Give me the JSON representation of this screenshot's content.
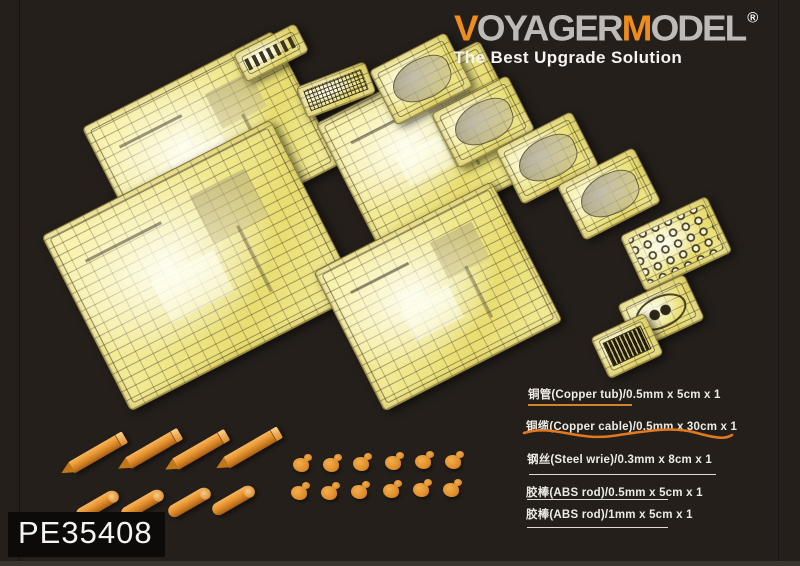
{
  "brand": {
    "wordmark": {
      "v": "V",
      "oyager": "OYAGER",
      "m": "M",
      "odel": "ODEL",
      "registered": "®"
    },
    "tagline": "The Best Upgrade Solution",
    "colors": {
      "orange": "#ef8c1e",
      "gray": "#bdbab7",
      "tagline": "#f4f4f2"
    }
  },
  "product": {
    "code": "PE35408"
  },
  "materials": {
    "items": [
      {
        "label": "铜管(Copper tub)/0.5mm x 5cm x 1",
        "sample": "straight-copper-line",
        "sample_color": "#cf852e"
      },
      {
        "label": "铜缆(Copper cable)/0.5mm x 30cm x 1",
        "sample": "wavy-copper-cable",
        "sample_color": "#e0791f"
      },
      {
        "label": "钢丝(Steel wrie)/0.3mm x 8cm x 1",
        "sample": "straight-white-line",
        "sample_color": "#dedbd4"
      },
      {
        "label": "胶棒(ABS rod)/0.5mm x 5cm x 1",
        "sample": "straight-white-line",
        "sample_color": "#dedbd4"
      },
      {
        "label": "胶棒(ABS rod)/1mm x 5cm x 1",
        "sample": "straight-white-line",
        "sample_color": "#dedbd4"
      }
    ]
  },
  "scene": {
    "background_color": "#241f1b",
    "photo_etch_brass_color": "#f2e993",
    "orange_parts_color": "#e78f2a",
    "photo_etch_sheets_visible": 13,
    "pointed_metal_rods": 4,
    "round_metal_rods": 4,
    "small_orange_parts": 12
  }
}
